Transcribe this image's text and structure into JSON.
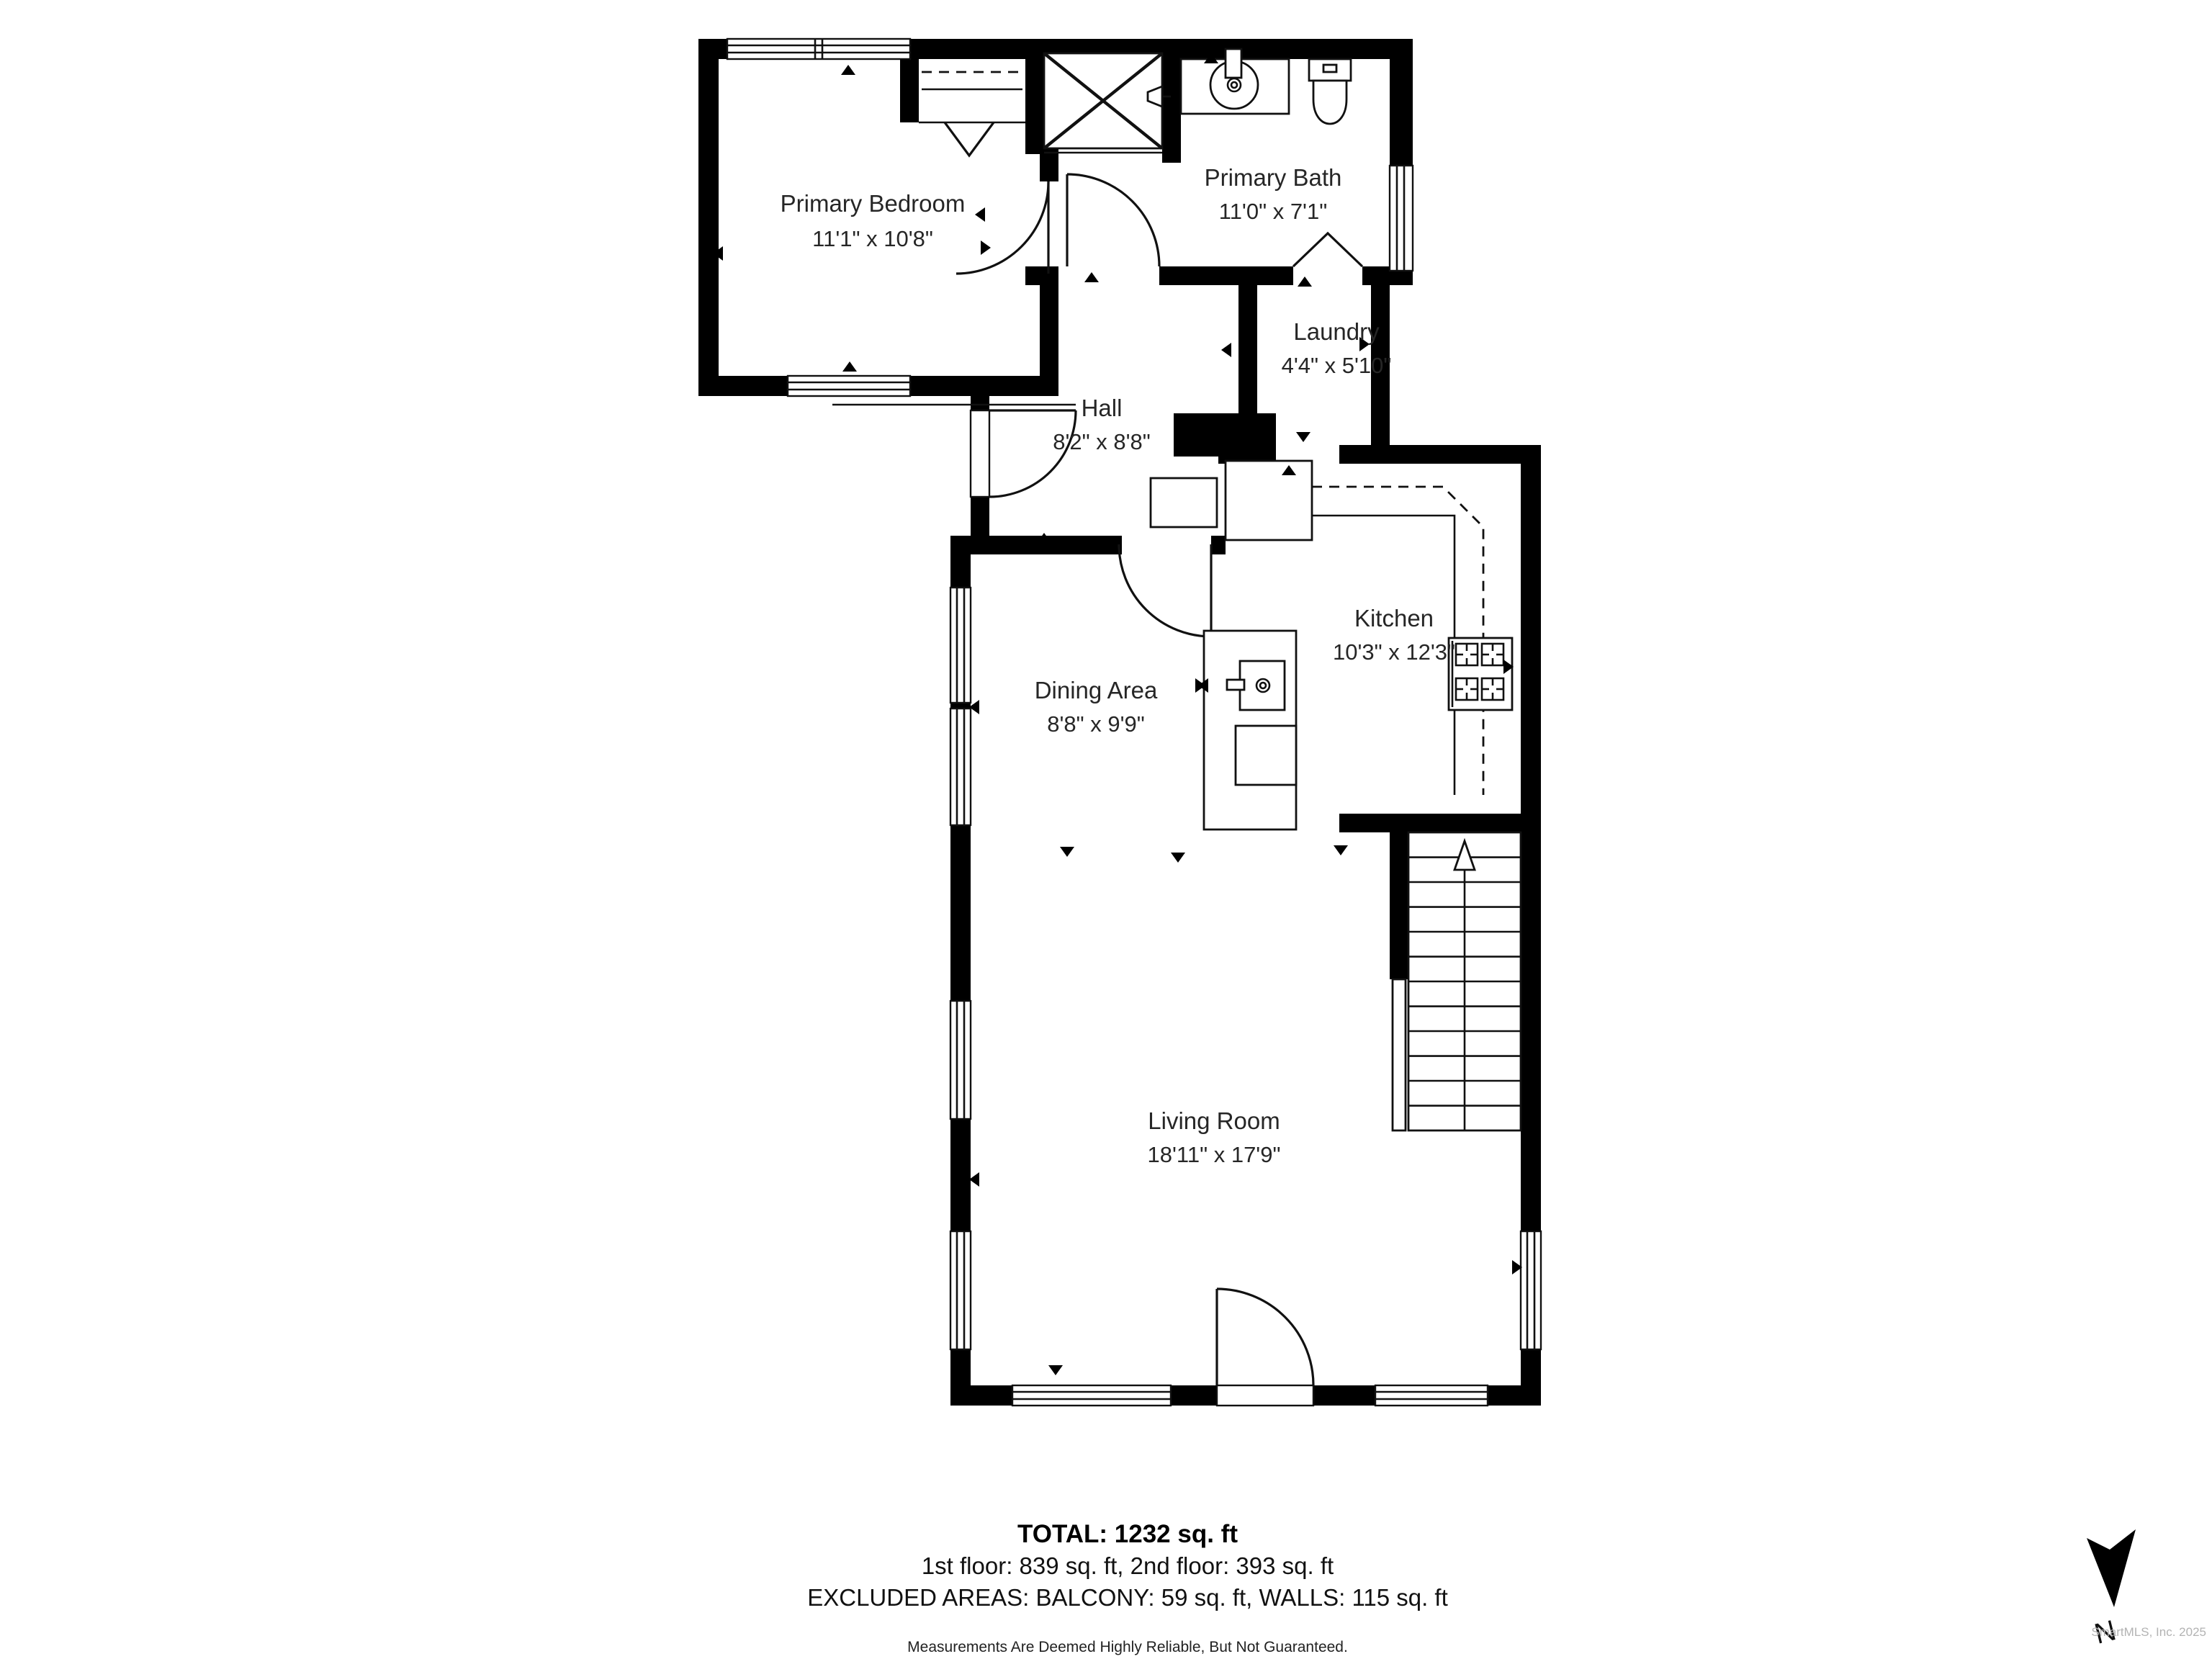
{
  "rooms": [
    {
      "name": "Primary Bedroom",
      "dims": "11'1\" x 10'8\""
    },
    {
      "name": "Primary Bath",
      "dims": "11'0\" x 7'1\""
    },
    {
      "name": "Laundry",
      "dims": "4'4\" x 5'10\""
    },
    {
      "name": "Hall",
      "dims": "8'2\" x 8'8\""
    },
    {
      "name": "Kitchen",
      "dims": "10'3\" x 12'3\""
    },
    {
      "name": "Dining Area",
      "dims": "8'8\" x 9'9\""
    },
    {
      "name": "Living Room",
      "dims": "18'11\" x 17'9\""
    }
  ],
  "summary": {
    "total": "TOTAL: 1232 sq. ft",
    "floors": "1st floor: 839 sq. ft, 2nd floor: 393 sq. ft",
    "excluded": "EXCLUDED AREAS: BALCONY: 59 sq. ft, WALLS: 115 sq. ft",
    "disclaimer": "Measurements Are Deemed Highly Reliable, But Not Guaranteed."
  },
  "compass": {
    "label": "N"
  },
  "watermark": "SmartMLS, Inc.  2025",
  "colors": {
    "wall": "#000000",
    "line": "#111111",
    "text": "#262626",
    "watermark": "#b3b3b3"
  }
}
